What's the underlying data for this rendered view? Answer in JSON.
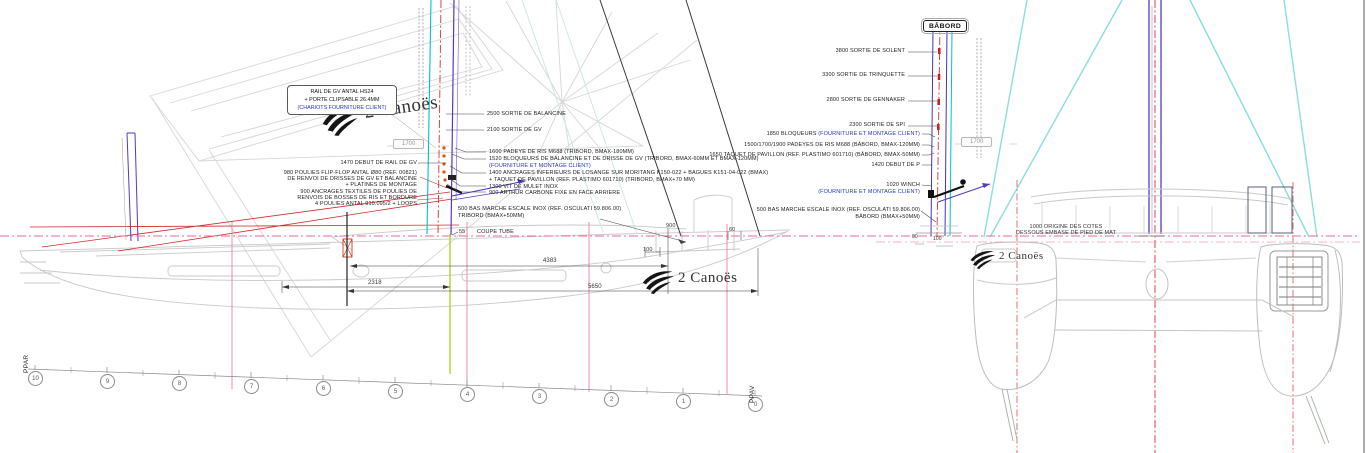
{
  "logo_text": "2 Canoës",
  "rail_box": {
    "line1": "RAIL DE GV ANTAL HS24",
    "line2": "+ PORTE CLIPSABLE 26.4MM",
    "line3": "(CHARIOTS FOURNITURE CLIENT)"
  },
  "left_block": {
    "rail_start": "1470 DEBUT DE RAIL DE GV",
    "poulies_l1": "980 POULIES FLIP-FLOP ANTAL Ø80 (REF. 00821)",
    "poulies_l2": "DE RENVOI DE DRISSES DE GV ET BALANCINE",
    "poulies_l3": "+ PLATINES DE MONTAGE",
    "ancrages_l1": "900 ANCRAGES TEXTILES DE POULIES DE",
    "ancrages_l2": "RENVOIS DE BOSSES DE RIS ET BORDURE",
    "ancrages_l3": "4 POULIES ANTAL 910.095/2 + LOOPS"
  },
  "tribord_block": {
    "sortie_balancine": "2500 SORTIE DE BALANCINE",
    "sortie_gv": "2100 SORTIE DE GV",
    "padeye": "1600 PADEYE DE RIS M688 (TRIBORD, BMAX-180MM)",
    "bloqueurs": "1520 BLOQUEURS DE BALANCINE ET DE DRISSE DE GV (TRIBORD, BMAX-60MM ET BMAX-120MM)",
    "bloqueurs_note": "(FOURNITURE ET MONTAGE CLIENT)",
    "ancrages_l1": "1400 ANCRAGES INFERIEURS DE LOSANGE SUR MORITANG K150-022 + BAGUES K151-04-022 (BMAX)",
    "ancrages_l2": "+ TAQUET DE PAVILLON (REF. PLASTIMO 601710) (TRIBORD, BMAX+70 MM)",
    "vit_mulet": "1300 VIT DE MULET INOX",
    "arthur": "900 ARTHUR CARBONE FIXE EN FACE ARRIERE",
    "bas_marche_l1": "500 BAS MARCHE ESCALE INOX (REF. OSCULATI 59.806.00)",
    "bas_marche_l2": "TRIBORD (BMAX+50MM)",
    "coupe_tube": "COUPE TUBE"
  },
  "babord_block": {
    "title": "BÂBORD",
    "sortie_solent": "3800 SORTIE DE SOLENT",
    "sortie_trinquette": "3300 SORTIE DE TRINQUETTE",
    "sortie_gennaker": "2800 SORTIE DE GENNAKER",
    "sortie_spi": "2300 SORTIE DE SPI",
    "bloqueurs": "1850 BLOQUEURS",
    "bloqueurs_note": "(FOURNITURE ET MONTAGE CLIENT)",
    "padeyes": "1500/1700/1900 PADEYES DE RIS M688 (BÂBORD, BMAX-120MM)",
    "taquet": "1650 TAQUET DE PAVILLON (REF. PLASTIMO 601710) (BÂBORD, BMAX-50MM)",
    "debut_p": "1420 DEBUT DE P",
    "winch": "1020 WINCH",
    "winch_note": "(FOURNITURE ET MONTAGE CLIENT)",
    "bas_marche_l1": "500 BAS MARCHE ESCALE INOX (REF. OSCULATI 59.806.00)",
    "bas_marche_l2": "BÂBORD (BMAX+50MM)"
  },
  "front_view": {
    "origin_l1": "1000 ORIGINE DES COTES",
    "origin_l2": "DESSOUS EMBASE DE PIED DE MAT"
  },
  "dims": {
    "d2318": "2318",
    "d4383": "4383",
    "d5650": "5650",
    "d900": "900",
    "d60": "60",
    "d100": "100",
    "d80": "80",
    "d100b": "100",
    "d55": "55",
    "d1700a": "1700",
    "d1700b": "1700"
  },
  "stations": {
    "ppar": "PPAR",
    "ppav": "PPAV",
    "numbers": [
      "10",
      "9",
      "8",
      "7",
      "6",
      "5",
      "4",
      "3",
      "2",
      "1",
      "0"
    ]
  }
}
